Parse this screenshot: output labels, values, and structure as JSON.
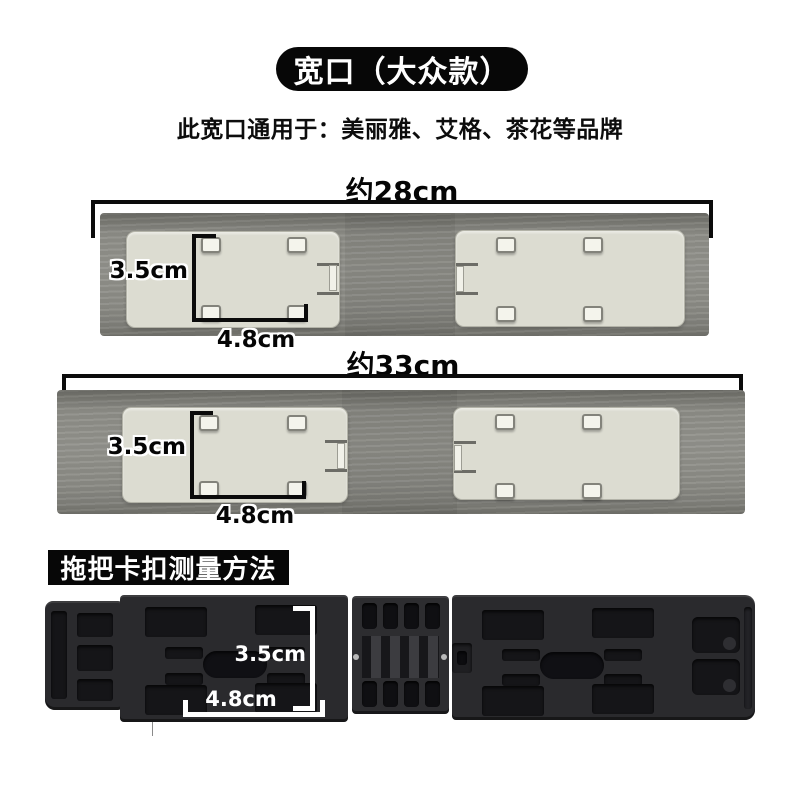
{
  "header": {
    "title": "宽口（大众款）",
    "subtitle": "此宽口通用于：美丽雅、艾格、茶花等品牌"
  },
  "bars": [
    {
      "name": "wide-mouth connector strip approx 28cm",
      "length_label": "约28cm",
      "clip_height_label": "3.5cm",
      "clip_width_label": "4.8cm"
    },
    {
      "name": "wide-mouth connector strip approx 33cm",
      "length_label": "约33cm",
      "clip_height_label": "3.5cm",
      "clip_width_label": "4.8cm"
    }
  ],
  "method_section": {
    "title": "拖把卡扣测量方法",
    "buckle_height_label": "3.5cm",
    "buckle_width_label": "4.8cm"
  },
  "colors": {
    "label_bg": "#070707",
    "bar_gray": "#8f8f89",
    "panel_cream": "#dcdcd1",
    "plastic_dark": "#2a2a2d",
    "annotation_black": "#050505",
    "annotation_white": "#ffffff"
  }
}
